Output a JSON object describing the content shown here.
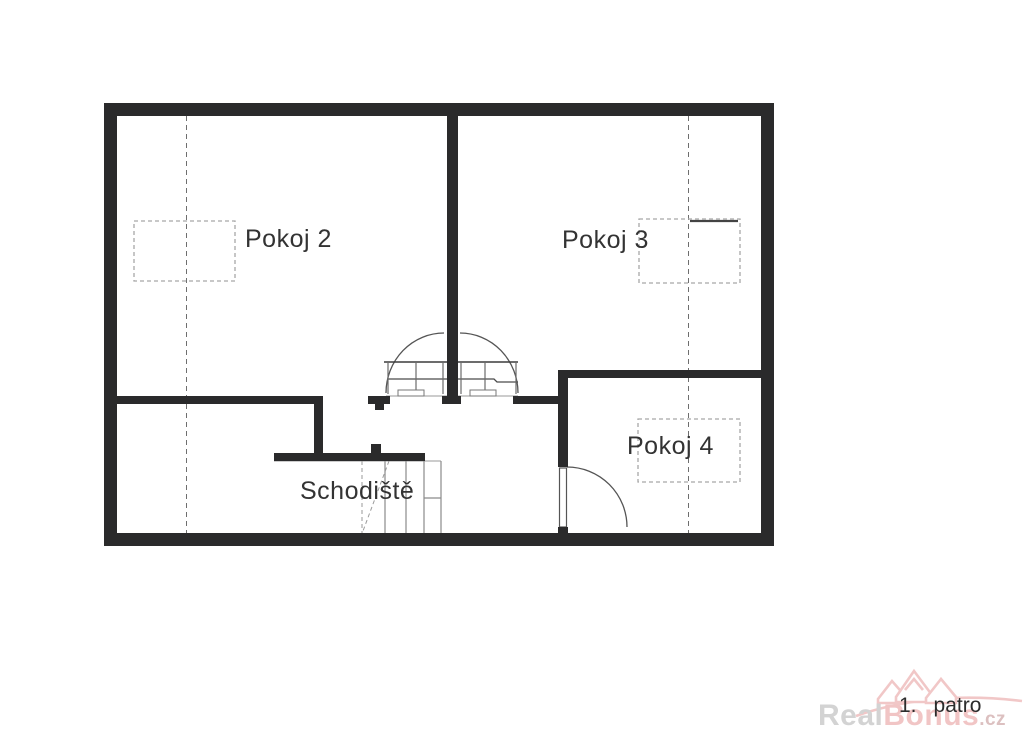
{
  "floor_plan": {
    "rooms": [
      {
        "id": "pokoj-2",
        "label": "Pokoj 2"
      },
      {
        "id": "pokoj-3",
        "label": "Pokoj 3"
      },
      {
        "id": "pokoj-4",
        "label": "Pokoj 4"
      },
      {
        "id": "schodiste",
        "label": "Schodiště"
      }
    ],
    "floor_indicator": {
      "number": "1.",
      "text": "patro"
    },
    "features": [
      "skylight-dashed-rect-pokoj-2",
      "skylight-dashed-rect-pokoj-3",
      "skylight-dashed-rect-pokoj-4",
      "section-line-left",
      "section-line-right",
      "double-door-swing-center",
      "door-swing-pokoj-4",
      "staircase-treads"
    ]
  },
  "watermark": {
    "brand_gray": "Real",
    "brand_pink": "Bonus",
    "brand_suffix": ".cz",
    "logo_icon": "realbonus-house-logo"
  },
  "colors": {
    "bg": "#ffffff",
    "wall": "#2a2a2b",
    "line": "#555555",
    "dashed": "#a8a8a8",
    "text": "#333333",
    "wm_gray": "#d3d3d3",
    "wm_pink": "#f1c5c5",
    "wm_suffix": "#dcc0c0"
  }
}
